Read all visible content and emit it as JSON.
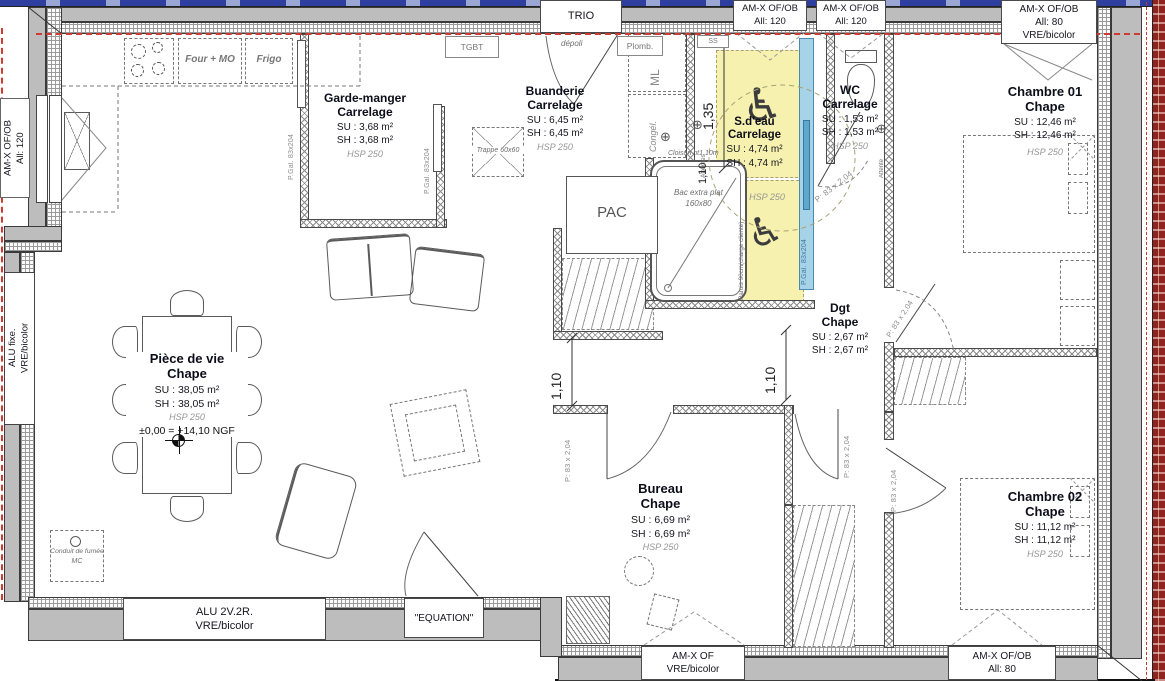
{
  "colors": {
    "wall_gray": "#bdbdbd",
    "red_dash": "#cf3a32",
    "yellow_zone": "#f6f1ae",
    "blue_door": "#a6d3e8",
    "brick_edge": "#8e241c",
    "top_band_blue": "#2e3f9f"
  },
  "rooms": {
    "garde_manger": {
      "name": "Garde-manger",
      "finish": "Carrelage",
      "su": "SU : 3,68 m²",
      "sh": "SH : 3,68 m²",
      "hsp": "HSP 250"
    },
    "buanderie": {
      "name": "Buanderie",
      "finish": "Carrelage",
      "su": "SU : 6,45 m²",
      "sh": "SH : 6,45 m²",
      "hsp": "HSP 250"
    },
    "sdeau": {
      "name": "S.d'eau",
      "finish": "Carrelage",
      "su": "SU : 4,74 m²",
      "sh": "SH : 4,74 m²",
      "hsp": "HSP 250"
    },
    "wc": {
      "name": "WC",
      "finish": "Carrelage",
      "su": "SU : 1,53 m²",
      "sh": "SH : 1,53 m²",
      "hsp": "HSP 250"
    },
    "chambre01": {
      "name": "Chambre 01",
      "finish": "Chape",
      "su": "SU : 12,46 m²",
      "sh": "SH : 12,46 m²",
      "hsp": "HSP 250"
    },
    "piece_de_vie": {
      "name": "Pièce de vie",
      "finish": "Chape",
      "su": "SU : 38,05 m²",
      "sh": "SH : 38,05 m²",
      "hsp": "HSP 250",
      "level": "±0,00 = +14,10 NGF"
    },
    "dgt": {
      "name": "Dgt",
      "finish": "Chape",
      "su": "SU : 2,67 m²",
      "sh": "SH : 2,67 m²"
    },
    "bureau": {
      "name": "Bureau",
      "finish": "Chape",
      "su": "SU : 6,69 m²",
      "sh": "SH : 6,69 m²",
      "hsp": "HSP 250"
    },
    "chambre02": {
      "name": "Chambre 02",
      "finish": "Chape",
      "su": "SU : 11,12 m²",
      "sh": "SH : 11,12 m²",
      "hsp": "HSP 250"
    }
  },
  "openings": {
    "trio": "TRIO",
    "equation": "\"EQUATION\"",
    "top_win1": {
      "l1": "AM-X OF/OB",
      "l2": "All: 120"
    },
    "top_win2": {
      "l1": "AM-X OF/OB",
      "l2": "All: 120"
    },
    "top_right": {
      "l1": "AM-X OF/OB",
      "l2": "All: 80",
      "l3": "VRE/bicolor"
    },
    "left_win": {
      "l1": "AM-X OF/OB",
      "l2": "All: 120"
    },
    "left_fixed": {
      "l1": "ALU fixe.",
      "l2": "VRE/bicolor"
    },
    "bottom_alu": {
      "l1": "ALU 2V.2R.",
      "l2": "VRE/bicolor"
    },
    "bottom_amx": {
      "l1": "AM-X OF",
      "l2": "VRE/bicolor"
    },
    "bottom_amxob": {
      "l1": "AM-X OF/OB",
      "l2": "All: 80"
    }
  },
  "doors": {
    "pgal": "P.Gal. 83x204",
    "p83": "P: 83 x 2,04"
  },
  "dims": {
    "d135": "1,35",
    "d110": "1,10"
  },
  "annotations": {
    "depoli": "dépoli",
    "tgbt": "TGBT",
    "plomb": "Plomb.",
    "ss": "SS",
    "ml": "ML",
    "congel": "Congél.",
    "pac": "PAC",
    "attentes": "Attentes",
    "attente": "Attente",
    "trappe": "Trappe 60x60",
    "bac1": "Bac extra plat",
    "bac2": "160x80",
    "cloison": "Cloison ht1.10m",
    "parois": "Parois 90cm(charge cliente)",
    "conduit": "Conduit de fumée",
    "mc": "MC",
    "four": "Four + MO",
    "frigo": "Frigo"
  },
  "icons": {
    "wheelchair_icon": "♿",
    "drain_icon": "⊕"
  }
}
